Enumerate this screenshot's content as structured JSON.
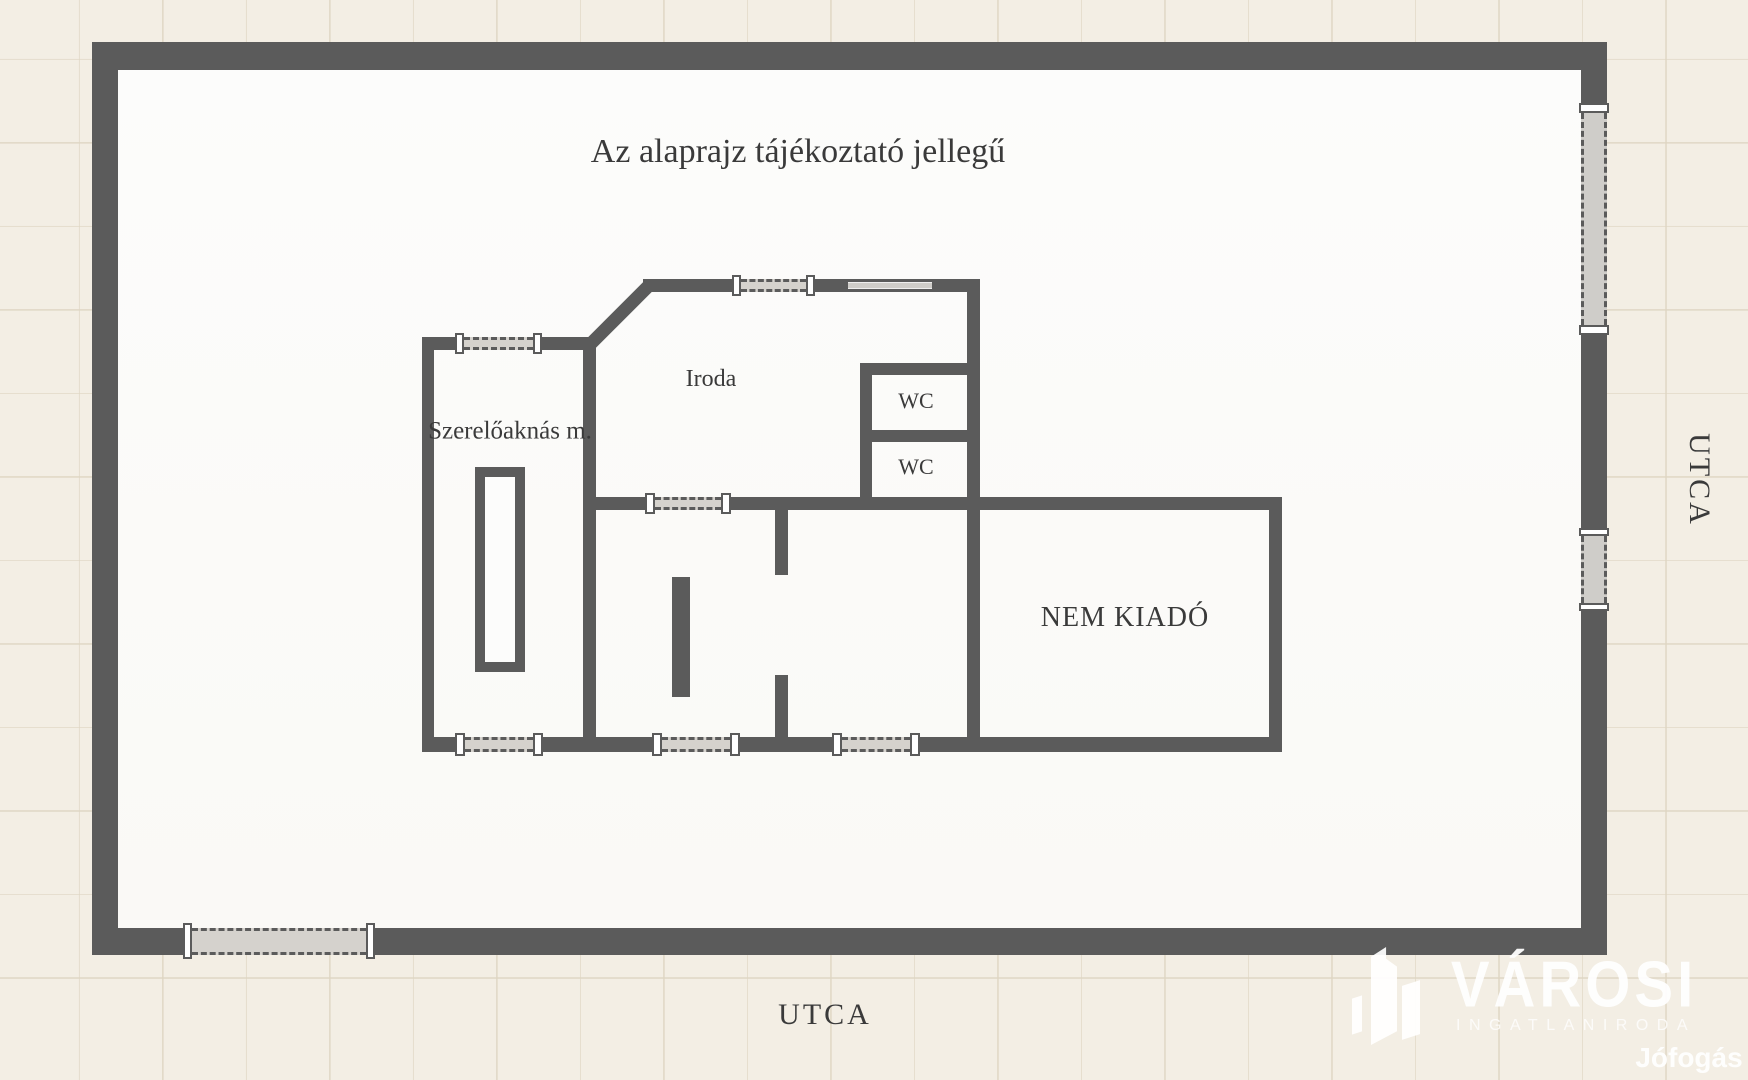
{
  "title": "Az alaprajz tájékoztató jellegű",
  "rooms": {
    "workshop": "Szerelőaknás m.",
    "office": "Iroda",
    "wc_upper": "WC",
    "wc_lower": "WC",
    "not_for_rent": "NEM KIADÓ"
  },
  "street": {
    "bottom": "UTCA",
    "right": "UTCA"
  },
  "branding": {
    "agency_name": "VÁROSI",
    "agency_subtitle": "INGATLANIRODA",
    "watermark": "Jófogás",
    "icon": "buildings-icon"
  },
  "colors": {
    "wall": "#5b5b5b",
    "background": "#f3eee4",
    "floor": "#fbfbf9",
    "grid_line": "#ded5c2",
    "door_fill": "#d5d2cd",
    "window_fill": "#cfcdc9",
    "text": "#3a3a3a",
    "logo": "#ffffff"
  }
}
